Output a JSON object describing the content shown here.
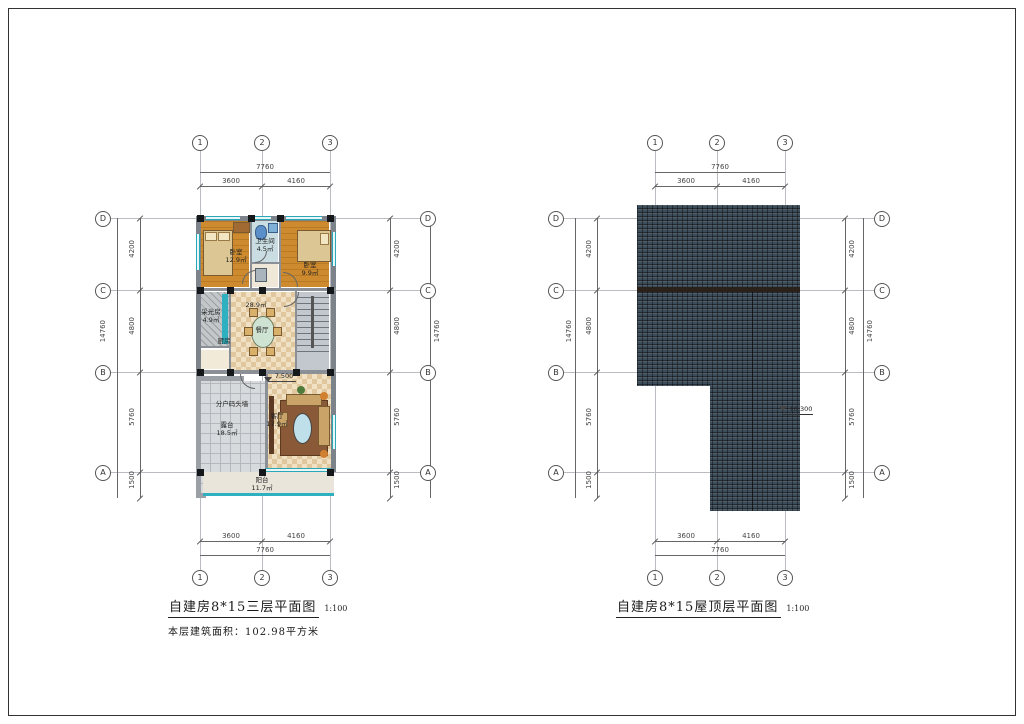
{
  "left_plan": {
    "title": "自建房8*15三层平面图",
    "scale": "1:100",
    "area_note": "本层建筑面积：102.98平方米",
    "axes_cols": [
      "1",
      "2",
      "3"
    ],
    "axes_rows": [
      "D",
      "C",
      "B",
      "A"
    ],
    "dim_top_total": "7760",
    "dim_top_segs": [
      "3600",
      "4160"
    ],
    "dim_bottom_segs": [
      "3600",
      "4160"
    ],
    "dim_bottom_total": "7760",
    "dim_side_segs": [
      "4200",
      "4800",
      "5760",
      "1500"
    ],
    "dim_side_total": "14760",
    "elevation": "7.500",
    "rooms": {
      "bedroom_left": {
        "name": "卧室",
        "area": "12.9㎡"
      },
      "bathroom": {
        "name": "卫生间",
        "area": "4.5㎡"
      },
      "bedroom_right": {
        "name": "卧室",
        "area": "9.9㎡"
      },
      "utility": {
        "name": "采光房",
        "area": "4.9㎡"
      },
      "kitchen": {
        "name": "厨房"
      },
      "dining": {
        "name": "餐厅",
        "area": "28.9㎡"
      },
      "living": {
        "name": "客厅",
        "area": "17.9㎡"
      },
      "terrace": {
        "name": "露台",
        "area": "18.5㎡"
      },
      "balcony": {
        "name": "阳台",
        "area": "11.7㎡"
      },
      "party_wall_note": "分户码头墙"
    }
  },
  "right_plan": {
    "title": "自建房8*15屋顶层平面图",
    "scale": "1:100",
    "axes_cols": [
      "1",
      "2",
      "3"
    ],
    "axes_rows": [
      "D",
      "C",
      "B",
      "A"
    ],
    "dim_top_total": "7760",
    "dim_top_segs": [
      "3600",
      "4160"
    ],
    "dim_bottom_segs": [
      "3600",
      "4160"
    ],
    "dim_bottom_total": "7760",
    "dim_side_segs": [
      "4200",
      "4800",
      "5760",
      "1500"
    ],
    "dim_side_total": "14760",
    "elevation": "10.300"
  },
  "colors": {
    "roof_tile": "#3d4c59",
    "ridge": "#2b211b",
    "glazing_teal": "#2ba8b8",
    "wood_floor": "#c8862c",
    "checker_floor": "#f0e0c4",
    "terrace_tile": "#d7dadc"
  }
}
